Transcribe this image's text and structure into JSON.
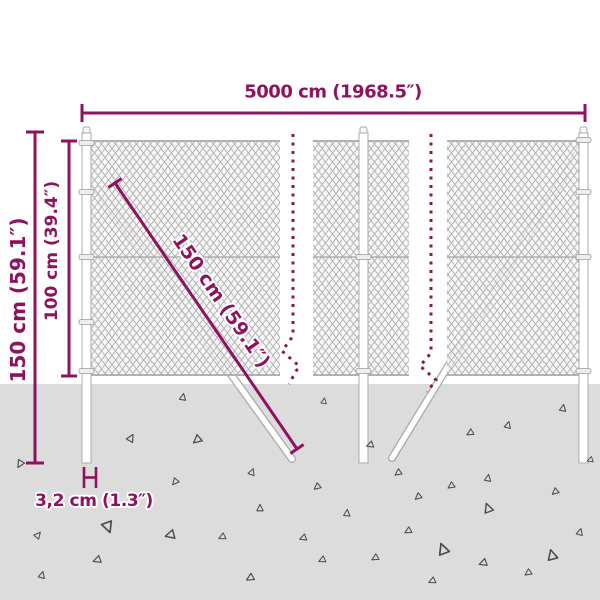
{
  "diagram": {
    "labels": {
      "total_width": "5000 cm (1968.5″)",
      "post_height": "150 cm (59.1″)",
      "mesh_height": "100 cm (39.4″)",
      "brace_length": "150 cm (59.1″)",
      "post_thickness": "3,2 cm (1.3″)"
    },
    "colors": {
      "dimension_accent": "#8e135f",
      "ground": "#dcdcdc",
      "mesh_line": "#b3b3b3",
      "structure_outline": "#a9a9a9",
      "gravel_triangle": "#4c4c4c",
      "background": "#ffffff"
    }
  }
}
